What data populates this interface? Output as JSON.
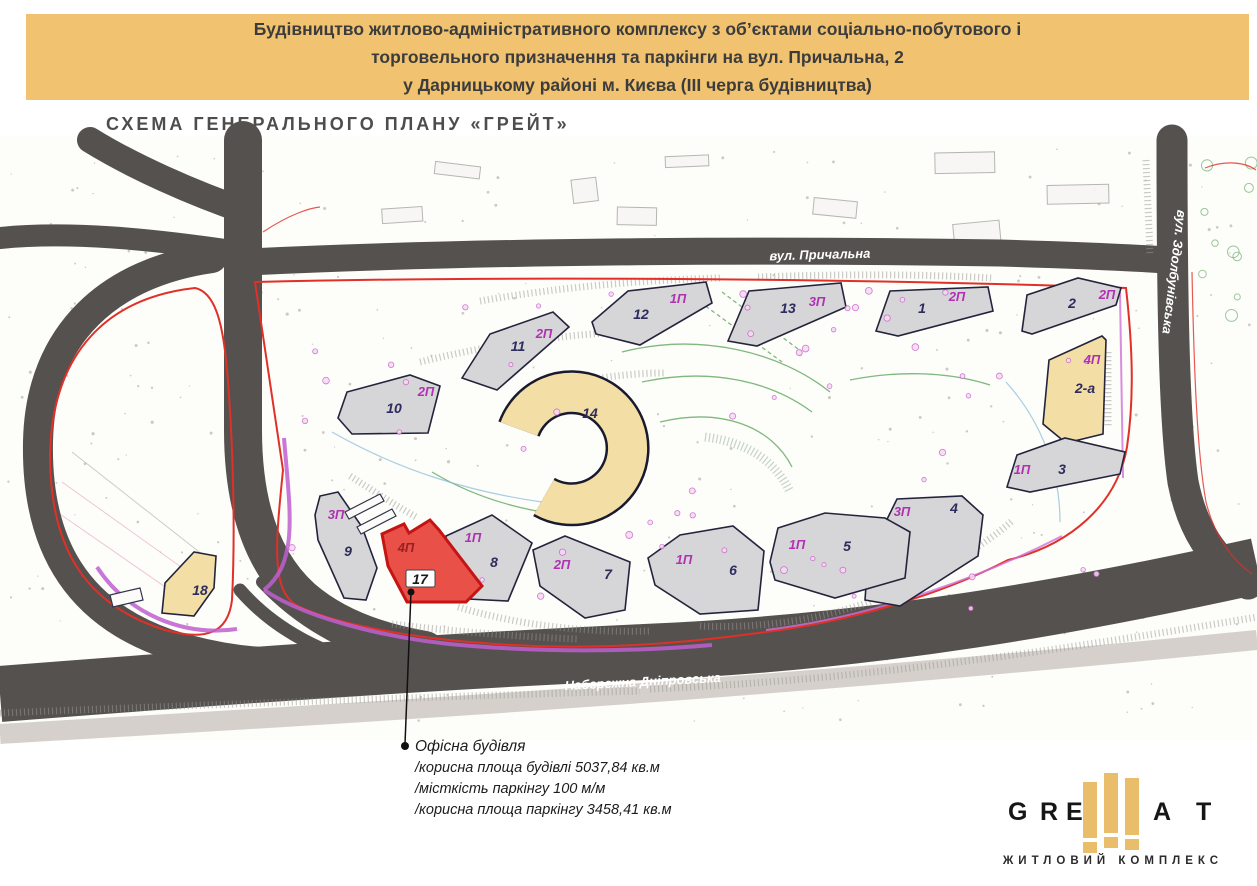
{
  "header": {
    "line1": "Будівництво житлово-адміністративного комплексу з об’єктами соціально-побутового і",
    "line2": "торговельного призначення та паркінги на вул. Причальна, 2",
    "line3": "у Дарницькому районі м. Києва (ІІІ черга будівництва)"
  },
  "title": "СХЕМА ГЕНЕРАЛЬНОГО ПЛАНУ «ГРЕЙТ»",
  "map": {
    "street_labels": [
      {
        "text": "вул. Причальна"
      },
      {
        "text": "Набережна Дніпровська"
      },
      {
        "text": "вул. Здолбунівська"
      }
    ],
    "buildings": [
      {
        "number": "12",
        "parking": "1П"
      },
      {
        "number": "13",
        "parking": "3П"
      },
      {
        "number": "1",
        "parking": "2П"
      },
      {
        "number": "2",
        "parking": "2П"
      },
      {
        "number": "11",
        "parking": "2П"
      },
      {
        "number": "10",
        "parking": "2П"
      },
      {
        "number": "14",
        "parking": ""
      },
      {
        "number": "2-а",
        "parking": "4П"
      },
      {
        "number": "3",
        "parking": "1П"
      },
      {
        "number": "4",
        "parking": "3П"
      },
      {
        "number": "9",
        "parking": "3П"
      },
      {
        "number": "17",
        "parking": "4П"
      },
      {
        "number": "8",
        "parking": "1П"
      },
      {
        "number": "7",
        "parking": "2П"
      },
      {
        "number": "6",
        "parking": "1П"
      },
      {
        "number": "5",
        "parking": "1П"
      },
      {
        "number": "18",
        "parking": ""
      }
    ]
  },
  "annotation": {
    "title": "Офісна будівля",
    "line1": "/корисна площа будівлі 5037,84 кв.м",
    "line2": "/місткість паркінгу 100 м/м",
    "line3": "/корисна площа паркінгу 3458,41 кв.м"
  },
  "logo": {
    "letters": [
      "G",
      "R",
      "E",
      "A",
      "T"
    ],
    "subtitle": "ЖИТЛОВИЙ КОМПЛЕКС"
  },
  "colors": {
    "header_bg": "#f1c26f",
    "road": "#55514e",
    "site_boundary_red": "#e03028",
    "utility_magenta": "#c05fd0",
    "building_gray": "#d6d5d7",
    "building_tan": "#f3dfa6",
    "highlight_red": "#e85048",
    "number_navy": "#2c2c5e",
    "parking_magenta": "#b032b2",
    "logo_gold": "#e9bd69"
  }
}
